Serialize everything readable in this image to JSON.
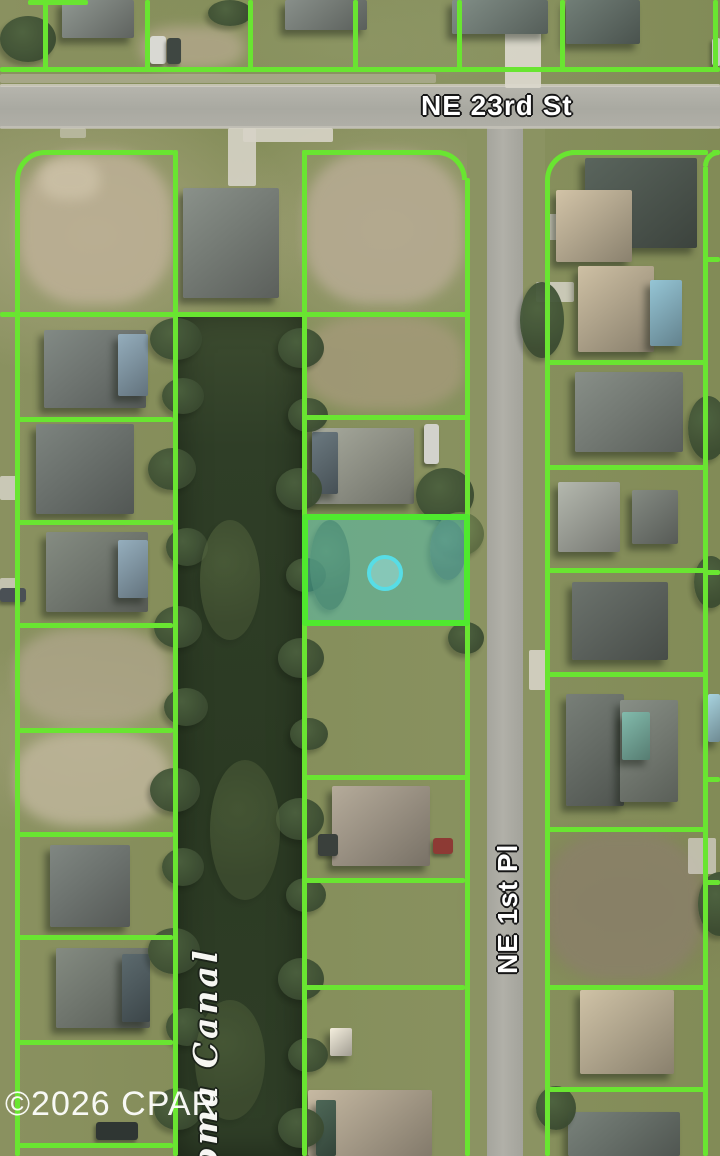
{
  "map": {
    "title": "Aerial parcel map",
    "streets": {
      "horizontal": "NE 23rd St",
      "vertical": "NE 1st Pl"
    },
    "canal": "oma Canal",
    "watermark": "©2026 CPAR",
    "colors": {
      "parcel_line": "#69e531",
      "highlight_border": "#4fe92e",
      "highlight_fill": "rgba(72,207,199,0.40)",
      "marker_ring": "#57dde6",
      "marker_fill": "rgba(154,224,222,0.55)",
      "water": "#2f3e27",
      "road": "#adaca3"
    }
  }
}
